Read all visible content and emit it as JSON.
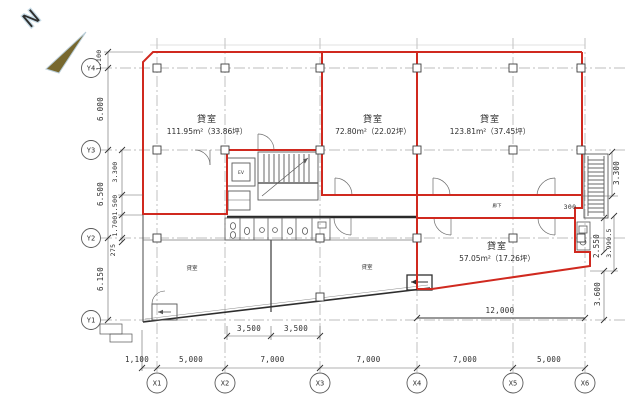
{
  "compass": {
    "north_label": "N"
  },
  "grid": {
    "x_labels": [
      "X1",
      "X2",
      "X3",
      "X4",
      "X5",
      "X6"
    ],
    "y_labels": [
      "Y4",
      "Y3",
      "Y2",
      "Y1"
    ]
  },
  "rooms": {
    "room1": {
      "name": "貸室",
      "area": "111.95m²（33.86坪）"
    },
    "room2": {
      "name": "貸室",
      "area": "72.80m²（22.02坪）"
    },
    "room3": {
      "name": "貸室",
      "area": "123.81m²（37.45坪）"
    },
    "room4": {
      "name": "貸室",
      "area": "57.05m²（17.26坪）"
    },
    "room5": {
      "name": "貸室"
    },
    "room6": {
      "name": "貸室"
    }
  },
  "labels": {
    "corridor": "廊下",
    "elevator": "EV"
  },
  "dimensions": {
    "bottom": [
      "1,100",
      "5,000",
      "7,000",
      "7,000",
      "7,000",
      "5,000"
    ],
    "middle": [
      "3,500",
      "3,500",
      "12,000"
    ],
    "left_outer": [
      "1.100",
      "6.000",
      "6.500",
      "6.150"
    ],
    "left_inner": [
      "3.300",
      "1.500",
      "1.700",
      "275"
    ],
    "right": [
      "3.300",
      "300",
      "2.550",
      "3.990.5",
      "3.600"
    ]
  },
  "colors": {
    "outline": "#d0291f",
    "compass": "#77682f"
  }
}
